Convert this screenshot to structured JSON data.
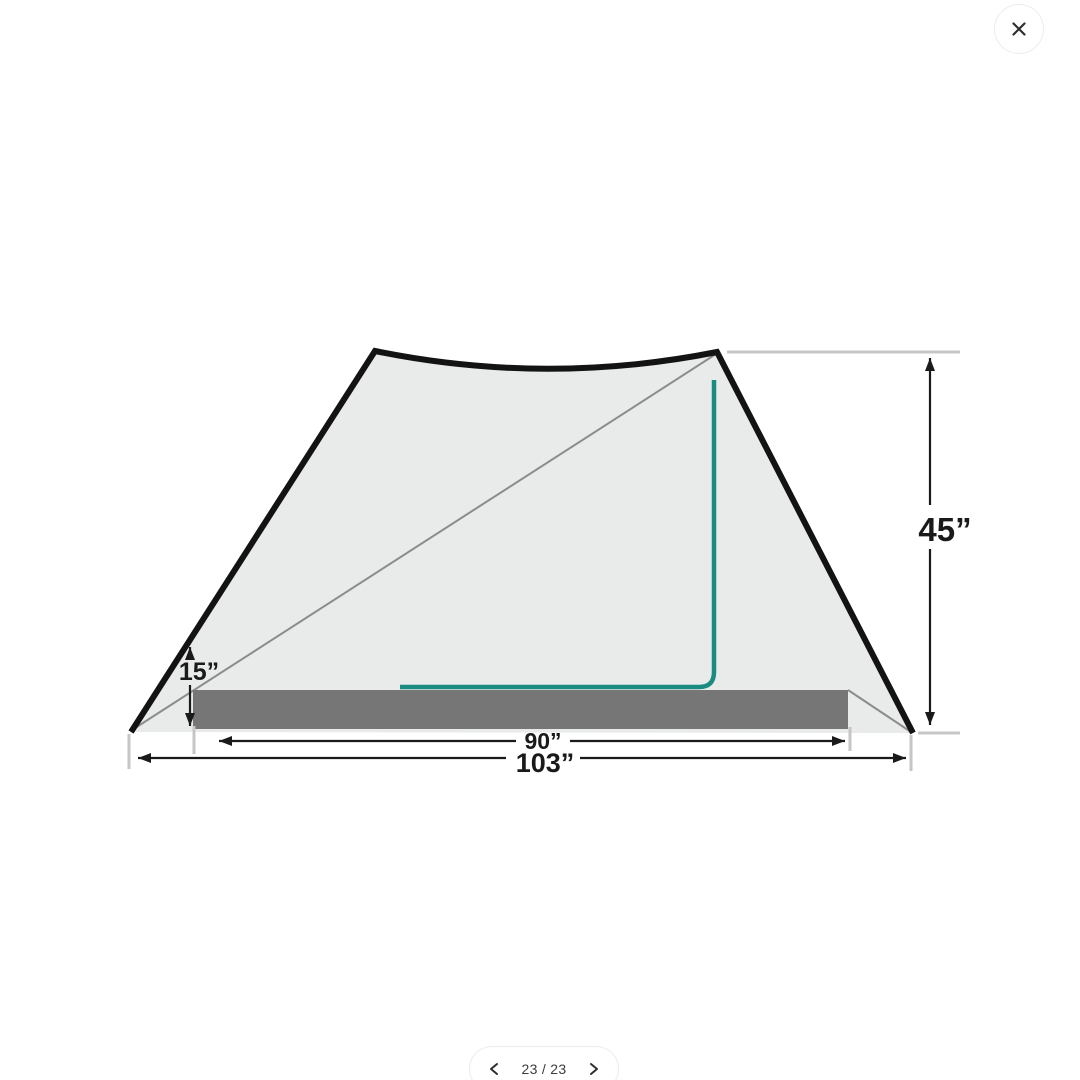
{
  "viewer": {
    "icons": {
      "close": "close-icon",
      "prev": "chevron-left-icon",
      "next": "chevron-right-icon"
    }
  },
  "pager": {
    "label": "23 / 23",
    "current_page": "23",
    "total_pages": "23"
  },
  "diagram": {
    "subject": "tent-dimensions-side-view",
    "measurements": {
      "peak_height": {
        "label": "45”",
        "value": 45,
        "unit": "in"
      },
      "end_height": {
        "label": "15”",
        "value": 15,
        "unit": "in"
      },
      "floor_width": {
        "label": "90”",
        "value": 90,
        "unit": "in"
      },
      "overall_width": {
        "label": "103”",
        "value": 103,
        "unit": "in"
      }
    },
    "colors": {
      "fabric": "#e9eaea",
      "floor": "#767676",
      "outline": "#131313",
      "accent_teal": "#1a8b81",
      "inner_line": "#8c8c8c",
      "extension": "#c6c6c6",
      "dimension": "#1a1a1a"
    }
  }
}
